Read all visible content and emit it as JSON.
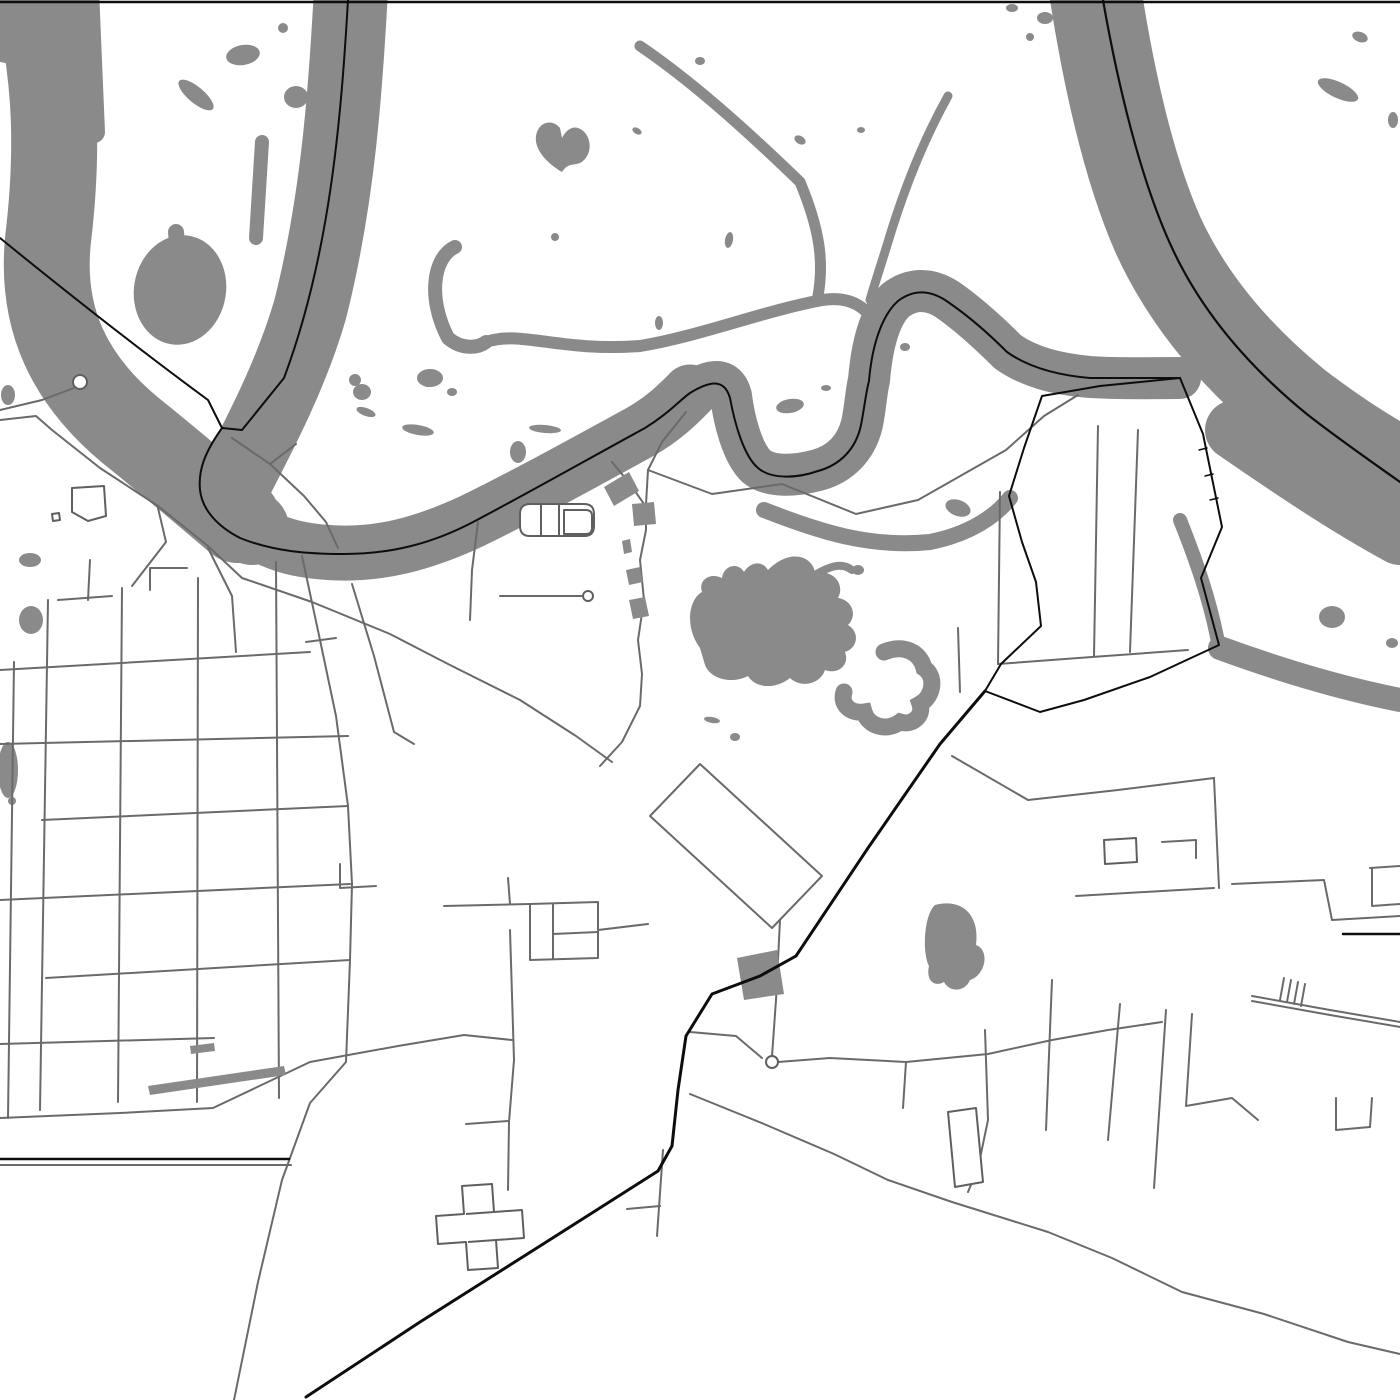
{
  "map": {
    "kind": "monochrome-street-map-poster",
    "canvas": {
      "width": 1400,
      "height": 1400
    },
    "colors": {
      "background": "#ffffff",
      "water": "#8a8a8a",
      "road": "#6a6a6a",
      "route": "#0d0d0d"
    },
    "layers": {
      "water_strokes": [
        {
          "d": "M30,-30 C55,60 60,140 48,240 C40,320 70,380 130,430 C170,462 205,492 238,520",
          "w": 86
        },
        {
          "d": "M88,-10 L94,132",
          "w": 22
        },
        {
          "d": "M176,232 L182,302",
          "w": 16
        },
        {
          "d": "M262,142 L256,238",
          "w": 14
        },
        {
          "d": "M352,-30 C346,90 338,200 310,310 C292,372 262,430 236,480 C228,498 232,515 252,528",
          "w": 74
        },
        {
          "d": "M238,520 C270,545 300,552 340,553 C380,554 420,545 470,522 C520,498 585,462 640,432 C665,418 680,402 690,392",
          "w": 55
        },
        {
          "d": "M690,392 C710,380 726,376 731,396 C734,420 742,452 756,466 C770,478 796,476 818,470 C840,464 856,448 862,424 C866,404 866,392 869,380 C872,344 880,314 896,300 C912,288 930,288 948,300 C968,314 988,332 1008,352 C1028,366 1054,374 1090,377 C1120,379 1150,378 1180,378",
          "w": 42
        },
        {
          "d": "M1092,-30 C1105,60 1125,160 1158,235 C1190,305 1240,360 1295,405 C1330,432 1365,455 1400,474",
          "w": 92
        },
        {
          "d": "M1235,430 C1290,468 1345,505 1400,535",
          "w": 60
        },
        {
          "d": "M455,247 C432,258 428,300 448,338 C462,350 478,348 486,342",
          "w": 14
        },
        {
          "d": "M486,342 C520,330 560,352 640,346 C700,336 760,312 822,300 C850,296 868,306 878,330",
          "w": 12
        },
        {
          "d": "M640,46 C690,80 742,126 800,182 C820,230 824,262 818,296",
          "w": 11
        },
        {
          "d": "M948,96 C928,132 906,182 888,242 C880,268 874,286 870,300",
          "w": 9
        },
        {
          "d": "M764,510 C820,532 870,548 930,542 C970,534 996,516 1010,498",
          "w": 16
        },
        {
          "d": "M1180,520 C1196,560 1210,600 1218,642",
          "w": 14
        },
        {
          "d": "M1220,648 C1280,670 1340,688 1400,700",
          "w": 24
        },
        {
          "d": "M815,575 C830,566 842,562 852,570",
          "w": 8
        }
      ],
      "water_fills": [
        {
          "d": "M700,648 C685,628 688,600 702,592 C698,580 710,572 722,578 C724,565 738,562 744,572 C750,562 762,560 768,570 C790,548 812,556 815,572 C835,570 845,585 838,598 C852,600 858,615 848,625 C860,632 858,648 845,652 C850,665 838,675 825,670 C820,685 800,688 790,678 C775,690 755,688 748,676 C730,685 710,678 705,665 Z"
        },
        {
          "d": "M560,128 C552,118 538,122 536,136 C534,150 548,164 562,172 C570,160 576,168 584,160 C594,150 590,132 578,128 C572,126 566,130 562,138 Z"
        },
        {
          "d": "M935,905 C962,898 980,915 976,945 C990,950 986,975 970,980 C965,992 950,993 944,982 C933,988 926,979 929,966 C922,952 924,915 935,905 Z"
        }
      ],
      "lake_c_arcs": [
        {
          "d": "M884,652 C904,644 920,652 924,668 C936,676 934,696 920,704 C924,716 912,726 900,722 C886,732 868,726 864,712 C850,714 840,704 844,692"
        }
      ],
      "blobs": [
        {
          "x": 20,
          "y": 30,
          "rx": 60,
          "ry": 34,
          "rot": 0
        },
        {
          "x": 180,
          "y": 290,
          "rx": 46,
          "ry": 55,
          "rot": 10
        },
        {
          "x": 243,
          "y": 55,
          "rx": 17,
          "ry": 10,
          "rot": -10
        },
        {
          "x": 196,
          "y": 95,
          "rx": 22,
          "ry": 8,
          "rot": 40
        },
        {
          "x": 283,
          "y": 28,
          "rx": 5,
          "ry": 5,
          "rot": 0
        },
        {
          "x": 296,
          "y": 97,
          "rx": 12,
          "ry": 11,
          "rot": 0
        },
        {
          "x": 428,
          "y": 383,
          "rx": 6,
          "ry": 4,
          "rot": 0
        },
        {
          "x": 452,
          "y": 392,
          "rx": 5,
          "ry": 4,
          "rot": 0
        },
        {
          "x": 355,
          "y": 380,
          "rx": 6,
          "ry": 6,
          "rot": 0
        },
        {
          "x": 362,
          "y": 392,
          "rx": 9,
          "ry": 8,
          "rot": 0
        },
        {
          "x": 366,
          "y": 412,
          "rx": 10,
          "ry": 4,
          "rot": 20
        },
        {
          "x": 418,
          "y": 430,
          "rx": 16,
          "ry": 5,
          "rot": 10
        },
        {
          "x": 430,
          "y": 378,
          "rx": 13,
          "ry": 9,
          "rot": 0
        },
        {
          "x": 8,
          "y": 395,
          "rx": 7,
          "ry": 10,
          "rot": 0
        },
        {
          "x": 700,
          "y": 61,
          "rx": 5,
          "ry": 4,
          "rot": 0
        },
        {
          "x": 637,
          "y": 131,
          "rx": 5,
          "ry": 3,
          "rot": 30
        },
        {
          "x": 555,
          "y": 237,
          "rx": 4,
          "ry": 4,
          "rot": 0
        },
        {
          "x": 659,
          "y": 323,
          "rx": 4,
          "ry": 7,
          "rot": 0
        },
        {
          "x": 729,
          "y": 240,
          "rx": 4,
          "ry": 8,
          "rot": 10
        },
        {
          "x": 800,
          "y": 140,
          "rx": 6,
          "ry": 4,
          "rot": 30
        },
        {
          "x": 861,
          "y": 130,
          "rx": 4,
          "ry": 3,
          "rot": 0
        },
        {
          "x": 905,
          "y": 347,
          "rx": 5,
          "ry": 4,
          "rot": 0
        },
        {
          "x": 790,
          "y": 406,
          "rx": 14,
          "ry": 7,
          "rot": -10
        },
        {
          "x": 826,
          "y": 388,
          "rx": 5,
          "ry": 3,
          "rot": 0
        },
        {
          "x": 958,
          "y": 508,
          "rx": 13,
          "ry": 8,
          "rot": 20
        },
        {
          "x": 545,
          "y": 429,
          "rx": 16,
          "ry": 4,
          "rot": 5
        },
        {
          "x": 518,
          "y": 452,
          "rx": 8,
          "ry": 11,
          "rot": 0
        },
        {
          "x": 1045,
          "y": 18,
          "rx": 8,
          "ry": 6,
          "rot": 0
        },
        {
          "x": 1012,
          "y": 8,
          "rx": 6,
          "ry": 4,
          "rot": 0
        },
        {
          "x": 1030,
          "y": 37,
          "rx": 4,
          "ry": 4,
          "rot": 0
        },
        {
          "x": 1338,
          "y": 90,
          "rx": 22,
          "ry": 8,
          "rot": 25
        },
        {
          "x": 1360,
          "y": 37,
          "rx": 8,
          "ry": 5,
          "rot": 20
        },
        {
          "x": 1393,
          "y": 120,
          "rx": 5,
          "ry": 8,
          "rot": 0
        },
        {
          "x": 1332,
          "y": 617,
          "rx": 13,
          "ry": 11,
          "rot": 0
        },
        {
          "x": 1392,
          "y": 643,
          "rx": 6,
          "ry": 5,
          "rot": 0
        },
        {
          "x": 1327,
          "y": 679,
          "rx": 7,
          "ry": 5,
          "rot": 0
        },
        {
          "x": 1345,
          "y": 683,
          "rx": 5,
          "ry": 4,
          "rot": 0
        },
        {
          "x": 858,
          "y": 570,
          "rx": 6,
          "ry": 5,
          "rot": 0
        },
        {
          "x": 712,
          "y": 720,
          "rx": 8,
          "ry": 3,
          "rot": 10
        },
        {
          "x": 735,
          "y": 737,
          "rx": 5,
          "ry": 4,
          "rot": 0
        },
        {
          "x": 30,
          "y": 560,
          "rx": 11,
          "ry": 7,
          "rot": 0
        },
        {
          "x": 31,
          "y": 620,
          "rx": 12,
          "ry": 14,
          "rot": 0
        },
        {
          "x": 8,
          "y": 770,
          "rx": 10,
          "ry": 28,
          "rot": 0
        },
        {
          "x": 12,
          "y": 801,
          "rx": 4,
          "ry": 4,
          "rot": 0
        }
      ],
      "roads": [
        {
          "d": "M14,662 L8,1118"
        },
        {
          "d": "M48,600 L40,1110"
        },
        {
          "d": "M122,588 L118,1102"
        },
        {
          "d": "M198,578 L197,1102"
        },
        {
          "d": "M276,562 L279,1098"
        },
        {
          "d": "M90,560 L88,600"
        },
        {
          "d": "M0,670 L310,652"
        },
        {
          "d": "M0,744 L348,736"
        },
        {
          "d": "M42,820 L348,806"
        },
        {
          "d": "M0,900 L350,884"
        },
        {
          "d": "M46,978 L350,960"
        },
        {
          "d": "M0,1044 L214,1038"
        },
        {
          "d": "M0,1118 L120,1113 L213,1108 L310,1062"
        },
        {
          "d": "M58,600 L112,596"
        },
        {
          "d": "M150,590 L150,568 L187,568"
        },
        {
          "d": "M158,508 L166,542 L132,586"
        },
        {
          "d": "M208,548 L232,596 L236,652"
        },
        {
          "d": "M302,556 L320,640 L336,716 L348,806 L352,884 L350,960 L346,1062 L310,1103 L282,1180 L258,1282 L234,1400"
        },
        {
          "d": "M352,584 L374,656 L394,732 L414,744"
        },
        {
          "d": "M306,642 L336,638"
        },
        {
          "d": "M340,864 L340,888 L376,886"
        },
        {
          "d": "M0,420 L36,416 L52,430 L100,468 L158,506 L208,546 L242,578 L312,602 L390,634 L448,664 L520,700 L576,736 L612,762"
        },
        {
          "d": "M0,410 L42,400 L74,388"
        },
        {
          "d": "M232,438 L270,464 L304,496 L326,522 L338,548"
        },
        {
          "d": "M270,464 L296,444"
        },
        {
          "d": "M612,462 L630,484 L644,504"
        },
        {
          "d": "M686,412 L662,442 L648,470 L646,504"
        },
        {
          "d": "M646,504 L646,530 L640,560 L644,600 L638,640 L642,674 L640,706 L622,742 L600,766"
        },
        {
          "d": "M500,596 L540,596 L582,596"
        },
        {
          "d": "M478,522 L472,570 L470,620"
        },
        {
          "d": "M700,764 L822,876 L772,928 L650,816 Z"
        },
        {
          "d": "M530,904 L598,902 L598,958 L530,960 Z"
        },
        {
          "d": "M553,904 L553,959"
        },
        {
          "d": "M553,934 L598,932"
        },
        {
          "d": "M598,930 L648,924"
        },
        {
          "d": "M508,878 L510,904"
        },
        {
          "d": "M444,906 L530,904"
        },
        {
          "d": "M510,930 L514,1060 L509,1122 L508,1190"
        },
        {
          "d": "M466,1124 L508,1121"
        },
        {
          "d": "M310,1062 L398,1046 L464,1035 L512,1040"
        },
        {
          "d": "M780,920 L776,1000 L772,1056"
        },
        {
          "d": "M690,1032 L736,1036 L762,1058"
        },
        {
          "d": "M778,1062 L830,1058 L906,1062 L988,1054 L1052,1040 L1108,1030 L1162,1022"
        },
        {
          "d": "M906,1062 L903,1108"
        },
        {
          "d": "M985,1030 L988,1120 L978,1168 L968,1192"
        },
        {
          "d": "M690,1094 L764,1124 L834,1154 L888,1180 L952,1202 L1048,1232 L1112,1258 L1182,1292 L1264,1314 L1348,1342 L1400,1354"
        },
        {
          "d": "M663,1150 L657,1236"
        },
        {
          "d": "M627,1209 L660,1206"
        },
        {
          "d": "M648,470 L712,494 L782,484 L856,514 L918,500 L1006,450 L1044,416 L1078,395"
        },
        {
          "d": "M1098,426 L1094,656"
        },
        {
          "d": "M1138,430 L1130,652"
        },
        {
          "d": "M1000,492 L998,664"
        },
        {
          "d": "M998,664 L1092,657 L1188,650"
        },
        {
          "d": "M958,628 L960,692"
        },
        {
          "d": "M952,756 L1028,800 L1118,790 L1214,778"
        },
        {
          "d": "M1214,778 L1219,888"
        },
        {
          "d": "M1076,896 L1214,888"
        },
        {
          "d": "M1052,980 L1046,1130"
        },
        {
          "d": "M1232,884 L1324,880 L1332,920 L1400,916"
        },
        {
          "d": "M1162,842 L1196,840 L1196,858"
        },
        {
          "d": "M1370,868 L1400,866"
        },
        {
          "d": "M1372,868 L1372,906 L1400,904"
        },
        {
          "d": "M1252,996 L1330,1010 L1400,1022"
        },
        {
          "d": "M1252,1001 L1330,1015 L1400,1027"
        },
        {
          "d": "M1284,978 L1280,1000"
        },
        {
          "d": "M1291,980 L1287,1002"
        },
        {
          "d": "M1298,982 L1294,1004"
        },
        {
          "d": "M1305,984 L1301,1006"
        },
        {
          "d": "M1120,1004 L1108,1140"
        },
        {
          "d": "M1166,1010 L1154,1188"
        },
        {
          "d": "M1192,1014 L1186,1106 L1232,1098 L1258,1120"
        },
        {
          "d": "M1336,1098 L1336,1130 L1370,1127"
        },
        {
          "d": "M1370,1127 L1372,1098"
        },
        {
          "d": "M0,1165 L291,1165"
        }
      ],
      "buildings_dark": [
        {
          "d": "M737,958 L777,950 L784,994 L744,1000 Z"
        },
        {
          "d": "M604,487 L629,472 L639,491 L614,506 Z"
        },
        {
          "d": "M632,504 L654,502 L656,524 L634,526 Z"
        },
        {
          "d": "M622,541 L630,539 L632,552 L624,554 Z"
        },
        {
          "d": "M626,570 L640,567 L643,582 L629,585 Z"
        },
        {
          "d": "M629,600 L645,597 L649,616 L633,619 Z"
        },
        {
          "d": "M148,1086 L284,1066 L286,1075 L150,1095 Z"
        },
        {
          "d": "M190,1046 L214,1043 L215,1051 L191,1054 Z"
        }
      ],
      "buildings_outline": [
        {
          "d": "M530,504 L584,504 Q594,504 594,514 L594,526 Q594,536 584,536 L530,536 Q520,536 520,526 L520,514 Q520,504 530,504 Z"
        },
        {
          "d": "M541,504 L541,536"
        },
        {
          "d": "M559,504 L559,536"
        },
        {
          "d": "M564,510 L586,510 Q592,510 592,516 L592,528 Q592,534 586,534 L564,534 Z"
        },
        {
          "d": "M72,488 L104,486 L106,516 L88,521 L72,512 Z"
        },
        {
          "d": "M52,514 L59,513 L60,520 L53,521 Z"
        },
        {
          "d": "M462,1186 L492,1184 L494,1212 L522,1210 L524,1238 L496,1240 L498,1268 L468,1270 L466,1242 L438,1244 L436,1216 L464,1214 Z"
        },
        {
          "d": "M466,1214 L494,1212"
        },
        {
          "d": "M468,1242 L496,1240"
        },
        {
          "d": "M948,1112 L976,1108 L983,1182 L955,1187 Z"
        },
        {
          "d": "M1104,840 L1136,838 L1137,862 L1105,864 Z"
        }
      ],
      "black_lines": [
        {
          "d": "M0,2 L1400,2",
          "w": 2.5
        },
        {
          "d": "M0,238 C70,295 140,350 208,400 L222,428",
          "w": 2
        },
        {
          "d": "M348,0 C341,120 330,255 284,378 L242,430 L222,428",
          "w": 2
        },
        {
          "d": "M222,428 C205,452 198,470 200,490 C202,508 215,525 240,538 C275,552 310,554 344,554 C390,554 432,544 475,521 C530,492 590,458 645,428 C668,414 680,400 690,393 C708,382 724,377 730,398 C735,425 744,456 758,468 C772,480 798,478 818,471 C840,465 856,449 861,425 C865,404 866,392 869,381 C872,345 882,315 898,301 C914,289 931,290 948,302 C967,315 988,333 1007,352 C1028,367 1055,375 1090,378 L1180,378",
          "w": 2
        },
        {
          "d": "M1103,0 C1117,80 1140,180 1173,250 C1205,318 1255,372 1308,415 C1340,440 1372,462 1400,482",
          "w": 2.2
        },
        {
          "d": "M1180,378 L1203,434 L1222,527 L1201,578 L1219,645 L1150,677 L1084,700 L1040,712 L985,691",
          "w": 2
        },
        {
          "d": "M1180,378 L1100,386 L1042,396 L1024,448 L1009,496 L1022,542 L1036,582 L1041,626 L1001,664 L985,691",
          "w": 2
        },
        {
          "d": "M985,691 L940,744 L868,848 L796,956 L760,976 L712,994 L686,1036 L678,1090 L672,1146 L658,1171 L540,1246 L420,1322 L306,1397",
          "w": 3
        },
        {
          "d": "M0,1159 L289,1159",
          "w": 2.5
        },
        {
          "d": "M1343,934 L1400,934",
          "w": 2.5
        },
        {
          "d": "M1199,450 L1207,448",
          "w": 1.5
        },
        {
          "d": "M1205,476 L1213,474",
          "w": 1.5
        },
        {
          "d": "M1210,500 L1218,498",
          "w": 1.5
        }
      ],
      "nodes": [
        {
          "x": 772,
          "y": 1062,
          "r": 6
        },
        {
          "x": 80,
          "y": 382,
          "r": 7
        },
        {
          "x": 588,
          "y": 596,
          "r": 5
        }
      ]
    }
  }
}
